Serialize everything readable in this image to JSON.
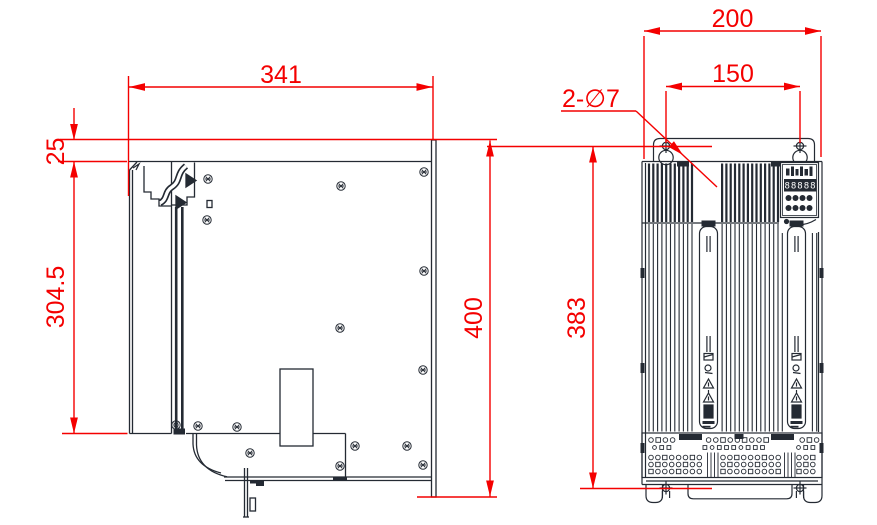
{
  "drawing": {
    "type": "engineering-dimension-drawing",
    "units": "mm",
    "colors": {
      "dimension_red": "#f40000",
      "line_dark": "#242a33",
      "background": "#ffffff",
      "display_bg": "#242a33",
      "display_text": "#ffffff"
    },
    "views": {
      "side": {
        "label": "side-view",
        "dimensions": {
          "width": "341",
          "top_flange_offset": "25",
          "heatsink_depth": "304.5",
          "backplate_height": "400"
        }
      },
      "front": {
        "label": "front-view",
        "dimensions": {
          "width": "200",
          "mounting_hole_spacing": "150",
          "mounting_hole_callout": "2-∅7",
          "height": "383"
        },
        "panel": {
          "display_value": "88888"
        }
      }
    }
  }
}
